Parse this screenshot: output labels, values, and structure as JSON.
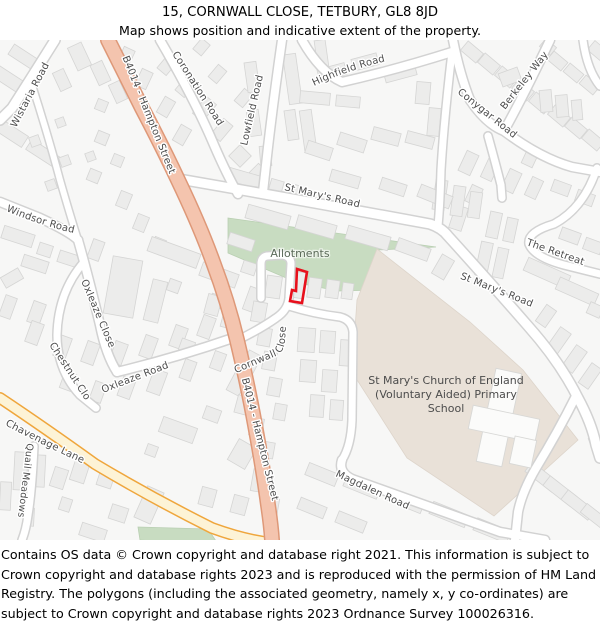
{
  "header": {
    "title": "15, CORNWALL CLOSE, TETBURY, GL8 8JD",
    "subtitle": "Map shows position and indicative extent of the property."
  },
  "map": {
    "labels": {
      "wistaria": "Wistaria Road",
      "b4014": "B4014 - Hampton Street",
      "coronation": "Coronation Road",
      "lowfield": "Lowfield Road",
      "highfield": "Highfield Road",
      "berkeley": "Berkeley Way",
      "conygar": "Conygar Road",
      "st_marys": "St Mary's Road",
      "the_retreat": "The Retreat",
      "windsor": "Windsor Road",
      "oxleaze_close": "Oxleaze Close",
      "chestnut_close": "Chestnut Close",
      "oxleaze_road": "Oxleaze Road",
      "chavenage": "Chavenage Lane",
      "quail_meadows": "Quail Meadows",
      "cornwall_close": "Cornwall Close",
      "magdalen": "Magdalen Road",
      "allotments": "Allotments",
      "school_lines": [
        "St Mary's Church of England",
        "(Voluntary Aided) Primary",
        "School"
      ]
    },
    "colors": {
      "primary_road_fill": "#f4c4ae",
      "primary_road_casing": "#de9878",
      "secondary_road_fill": "#fdf3d6",
      "secondary_road_casing": "#efa63c",
      "minor_road_fill": "#ffffff",
      "minor_road_casing": "#d2d2d2",
      "allotments_green": "#c8dcc1",
      "school_beige": "#e9e1d8",
      "building_fill": "#ececeb",
      "property_outline_red": "#e8101c"
    }
  },
  "footer": {
    "attribution": "Contains OS data © Crown copyright and database right 2021. This information is subject to Crown copyright and database rights 2023 and is reproduced with the permission of HM Land Registry. The polygons (including the associated geometry, namely x, y co-ordinates) are subject to Crown copyright and database rights 2023 Ordnance Survey 100026316."
  }
}
